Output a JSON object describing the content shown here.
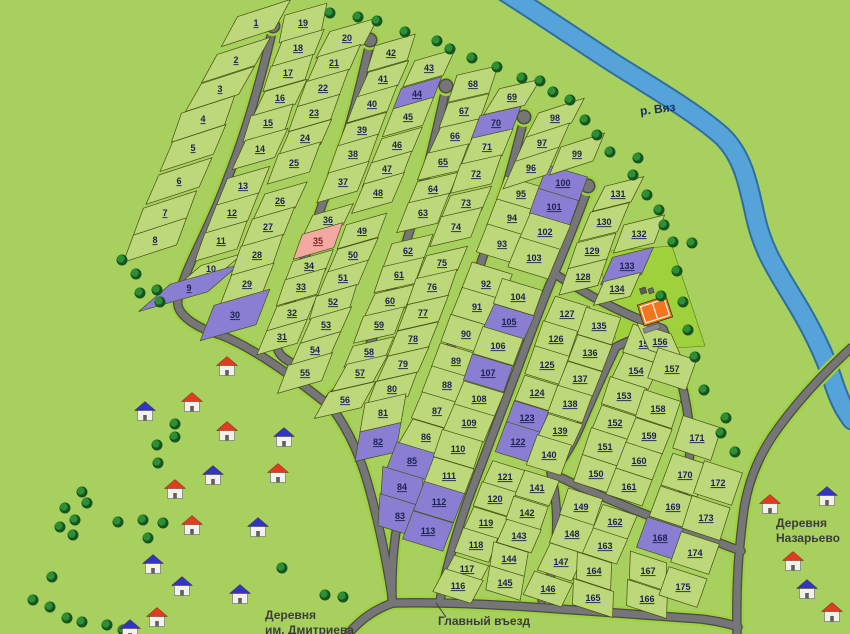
{
  "map": {
    "width": 850,
    "height": 634,
    "colors": {
      "background": "#a7d05f",
      "parcel": "#bdd77b",
      "parcel_stroke": "#45510f",
      "parcel_sold": "#8a7ed2",
      "parcel_reserved": "#f4a8a2",
      "road": "#767676",
      "road_casing": "#4a4a4a",
      "verge": "#9ed13c",
      "river": "#56a3d9",
      "river_edge": "#2f6f9f",
      "tree_dark": "#15541d",
      "tree_light": "#2e8f36",
      "court": "#f2761d",
      "number_text": "#1b2150",
      "number_text_reserved": "#7c1f1f"
    },
    "labels": {
      "river": "р. Вяз",
      "entrance": "Главный въезд",
      "village_sw": "Деревня\nим. Дмитриева",
      "village_se": "Деревня\nНазарьево"
    },
    "river": {
      "d": "M505,-8 C540,14 575,38 612,62 C650,86 695,112 722,136 C742,155 748,182 755,215 C762,248 775,268 792,296 C810,325 824,352 833,381 C840,403 846,412 852,420"
    },
    "court": {
      "x": 655,
      "y": 311,
      "rot": -18,
      "w": 30,
      "h": 22,
      "apron": "598,252 672,246 705,346 618,352"
    },
    "roads": [
      {
        "d": "M273,28 C258,92 243,140 227,180 C207,235 184,268 178,300 C175,314 196,328 221,335 C258,350 300,382 332,408 C350,432 362,460 371,495 C381,533 388,568 393,603"
      },
      {
        "d": "M370,42 C355,112 340,162 323,202 C306,252 292,300 280,334 C276,345 276,352 284,358 L296,366"
      },
      {
        "d": "M446,88 C433,150 420,198 406,243 C391,293 377,333 362,360 C353,376 341,388 330,398"
      },
      {
        "d": "M524,119 C511,172 499,214 484,254 C467,303 452,343 439,378 C426,413 416,453 406,489 C396,520 391,558 392,601"
      },
      {
        "d": "M588,188 C576,222 563,253 550,284 C536,318 524,352 511,386 C497,424 482,462 468,500 C456,534 446,568 440,601"
      },
      {
        "d": "M552,272 C578,289 606,305 634,317 L663,329"
      },
      {
        "d": "M663,329 C643,336 627,341 616,347 C603,374 591,401 580,427 C571,448 560,464 551,473"
      },
      {
        "d": "M551,473 C558,504 559,539 551,574 C549,584 545,592 542,600"
      },
      {
        "d": "M551,473 C586,490 621,505 660,520"
      },
      {
        "d": "M663,329 C678,363 687,399 690,433 C691,463 686,496 672,521"
      },
      {
        "d": "M660,520 C688,531 714,541 741,551"
      },
      {
        "d": "M851,348 C826,371 801,397 779,427 C761,451 749,477 744,509 C739,547 736,580 737,633"
      },
      {
        "d": "M349,633 C361,619 375,609 393,603 C440,602 481,604 531,607 C586,611 641,615 701,619 C716,621 728,623 738,627"
      }
    ],
    "road_bulbs": [
      [
        273,
        26
      ],
      [
        370,
        40
      ],
      [
        446,
        86
      ],
      [
        524,
        117
      ],
      [
        588,
        186
      ]
    ],
    "entrance_leader": {
      "x1": 436,
      "y1": 603,
      "x2": 446,
      "y2": 617
    }
  },
  "plots": {
    "1": [
      256,
      23
    ],
    "2": [
      236,
      60
    ],
    "3": [
      220,
      89
    ],
    "4": [
      203,
      119
    ],
    "5": [
      193,
      148
    ],
    "6": [
      179,
      181
    ],
    "7": [
      165,
      213
    ],
    "8": [
      155,
      240
    ],
    "9": [
      189,
      288,
      "p"
    ],
    "10": [
      211,
      269
    ],
    "11": [
      221,
      241
    ],
    "12": [
      232,
      213
    ],
    "13": [
      243,
      186
    ],
    "14": [
      260,
      149
    ],
    "15": [
      268,
      123
    ],
    "16": [
      280,
      98
    ],
    "17": [
      288,
      73
    ],
    "18": [
      298,
      48
    ],
    "19": [
      303,
      23
    ],
    "20": [
      347,
      38
    ],
    "21": [
      334,
      63
    ],
    "22": [
      323,
      88
    ],
    "23": [
      314,
      113
    ],
    "24": [
      305,
      138
    ],
    "25": [
      294,
      163
    ],
    "26": [
      280,
      201
    ],
    "27": [
      268,
      227
    ],
    "28": [
      257,
      255
    ],
    "29": [
      247,
      284
    ],
    "30": [
      235,
      315,
      "p"
    ],
    "31": [
      282,
      337
    ],
    "32": [
      292,
      313
    ],
    "33": [
      301,
      287
    ],
    "34": [
      309,
      266
    ],
    "35": [
      318,
      241,
      "r"
    ],
    "36": [
      328,
      220
    ],
    "37": [
      343,
      182
    ],
    "38": [
      353,
      154
    ],
    "39": [
      362,
      130
    ],
    "40": [
      372,
      104
    ],
    "41": [
      383,
      79
    ],
    "42": [
      391,
      53
    ],
    "43": [
      429,
      68
    ],
    "44": [
      417,
      94,
      "p"
    ],
    "45": [
      408,
      117
    ],
    "46": [
      397,
      145
    ],
    "47": [
      387,
      169
    ],
    "48": [
      378,
      193
    ],
    "49": [
      362,
      231
    ],
    "50": [
      353,
      255
    ],
    "51": [
      343,
      278
    ],
    "52": [
      333,
      302
    ],
    "53": [
      326,
      325
    ],
    "54": [
      315,
      350
    ],
    "55": [
      305,
      373
    ],
    "56": [
      345,
      400
    ],
    "57": [
      360,
      373
    ],
    "58": [
      369,
      352
    ],
    "59": [
      379,
      325
    ],
    "60": [
      390,
      301
    ],
    "61": [
      399,
      275
    ],
    "62": [
      408,
      251
    ],
    "63": [
      423,
      213
    ],
    "64": [
      433,
      189
    ],
    "65": [
      443,
      162
    ],
    "66": [
      455,
      136
    ],
    "67": [
      464,
      111
    ],
    "68": [
      473,
      84
    ],
    "69": [
      512,
      97
    ],
    "70": [
      496,
      123,
      "p"
    ],
    "71": [
      487,
      147
    ],
    "72": [
      476,
      174
    ],
    "73": [
      466,
      203
    ],
    "74": [
      456,
      227
    ],
    "75": [
      442,
      263
    ],
    "76": [
      432,
      287
    ],
    "77": [
      423,
      313
    ],
    "78": [
      413,
      339
    ],
    "79": [
      403,
      364
    ],
    "80": [
      392,
      389
    ],
    "81": [
      383,
      413
    ],
    "82": [
      378,
      442,
      "p"
    ],
    "83": [
      400,
      516,
      "p"
    ],
    "84": [
      402,
      487,
      "p"
    ],
    "85": [
      412,
      461,
      "p"
    ],
    "86": [
      426,
      437
    ],
    "87": [
      437,
      411
    ],
    "88": [
      447,
      385
    ],
    "89": [
      456,
      361
    ],
    "90": [
      466,
      334
    ],
    "91": [
      477,
      307
    ],
    "92": [
      486,
      284
    ],
    "93": [
      502,
      244
    ],
    "94": [
      512,
      218
    ],
    "95": [
      521,
      194
    ],
    "96": [
      531,
      168
    ],
    "97": [
      542,
      143
    ],
    "98": [
      555,
      118
    ],
    "99": [
      577,
      154
    ],
    "100": [
      563,
      183,
      "p"
    ],
    "101": [
      554,
      207,
      "p"
    ],
    "102": [
      545,
      232
    ],
    "103": [
      534,
      258
    ],
    "104": [
      518,
      297
    ],
    "105": [
      509,
      322,
      "p"
    ],
    "106": [
      498,
      346
    ],
    "107": [
      488,
      373,
      "p"
    ],
    "108": [
      479,
      399
    ],
    "109": [
      469,
      423
    ],
    "110": [
      458,
      449
    ],
    "111": [
      449,
      476
    ],
    "112": [
      439,
      502,
      "p"
    ],
    "113": [
      428,
      531,
      "p"
    ],
    "114": [
      413,
      558
    ],
    "115": [
      408,
      582
    ],
    "116": [
      458,
      586
    ],
    "117": [
      467,
      569
    ],
    "118": [
      476,
      545
    ],
    "119": [
      486,
      523
    ],
    "120": [
      495,
      499
    ],
    "121": [
      505,
      477
    ],
    "122": [
      518,
      442,
      "p"
    ],
    "123": [
      527,
      418,
      "p"
    ],
    "124": [
      537,
      393
    ],
    "125": [
      547,
      365
    ],
    "126": [
      556,
      339
    ],
    "127": [
      567,
      314
    ],
    "128": [
      583,
      277
    ],
    "129": [
      592,
      251
    ],
    "130": [
      604,
      222
    ],
    "131": [
      618,
      194
    ],
    "132": [
      639,
      234
    ],
    "133": [
      627,
      266,
      "p"
    ],
    "134": [
      617,
      289
    ],
    "135": [
      599,
      326
    ],
    "136": [
      590,
      353
    ],
    "137": [
      580,
      379
    ],
    "138": [
      570,
      404
    ],
    "139": [
      560,
      431
    ],
    "140": [
      549,
      455
    ],
    "141": [
      537,
      488
    ],
    "142": [
      527,
      513
    ],
    "143": [
      519,
      536
    ],
    "144": [
      509,
      559
    ],
    "145": [
      505,
      583
    ],
    "146": [
      548,
      589
    ],
    "147": [
      561,
      562
    ],
    "148": [
      572,
      534
    ],
    "149": [
      581,
      507
    ],
    "150": [
      596,
      474
    ],
    "151": [
      605,
      447
    ],
    "152": [
      615,
      423
    ],
    "153": [
      624,
      396
    ],
    "154": [
      636,
      371
    ],
    "155": [
      646,
      344
    ],
    "156": [
      660,
      342
    ],
    "157": [
      672,
      369
    ],
    "158": [
      658,
      409
    ],
    "159": [
      649,
      436
    ],
    "160": [
      639,
      461
    ],
    "161": [
      629,
      487
    ],
    "162": [
      615,
      522
    ],
    "163": [
      605,
      546
    ],
    "164": [
      594,
      571
    ],
    "165": [
      593,
      598
    ],
    "166": [
      647,
      599
    ],
    "167": [
      648,
      571
    ],
    "168": [
      660,
      538,
      "p"
    ],
    "169": [
      673,
      507
    ],
    "170": [
      685,
      475
    ],
    "171": [
      697,
      438
    ],
    "172": [
      718,
      483
    ],
    "173": [
      706,
      518
    ],
    "174": [
      695,
      553
    ],
    "175": [
      683,
      587
    ]
  },
  "blocks": [
    {
      "id": "b1",
      "edge": -18,
      "w": 56,
      "dir": [
        -16,
        30
      ],
      "cols": [
        [
          1,
          2,
          3,
          4,
          5,
          6,
          7,
          8
        ]
      ]
    },
    {
      "id": "b2",
      "edge": -16,
      "w": 44,
      "dir": [
        -10,
        26
      ],
      "cols": [
        [
          19,
          18,
          17,
          16,
          15,
          14,
          13,
          12,
          11,
          10,
          9
        ],
        [
          20,
          21,
          22,
          23,
          24,
          25,
          26,
          27,
          28,
          29,
          30
        ]
      ]
    },
    {
      "id": "b3",
      "edge": -16,
      "w": 42,
      "dir": [
        -10,
        26
      ],
      "cols": [
        [
          42,
          41,
          40,
          39,
          38,
          37,
          36,
          35,
          34,
          33,
          32,
          31
        ],
        [
          43,
          44,
          45,
          46,
          47,
          48,
          49,
          50,
          51,
          52,
          53,
          54
        ],
        [
          55
        ]
      ]
    },
    {
      "id": "b4",
      "edge": -13,
      "w": 42,
      "dir": [
        -10,
        26
      ],
      "cols": [
        [
          68,
          67,
          66,
          65,
          64,
          63,
          62,
          61,
          60,
          59,
          58,
          57,
          56
        ],
        [
          69,
          70,
          71,
          72,
          73,
          74,
          75,
          76,
          77,
          78,
          79,
          80,
          81,
          82
        ]
      ]
    },
    {
      "id": "b5",
      "edge": 17,
      "w": 42,
      "dir": [
        -10,
        26
      ],
      "cols": [
        [
          95,
          94,
          93,
          92,
          91,
          90,
          89,
          88,
          87,
          86,
          85,
          84,
          83
        ],
        [
          100,
          101,
          102,
          103,
          104,
          105,
          106,
          107,
          108,
          109,
          110,
          111,
          112,
          113
        ]
      ]
    },
    {
      "id": "b6",
      "edge": -18,
      "w": 46,
      "dir": [
        -11,
        27
      ],
      "cols": [
        [
          98,
          97,
          96
        ],
        [
          99
        ]
      ]
    },
    {
      "id": "b7",
      "edge": -14,
      "w": 40,
      "dir": [
        -11,
        27
      ],
      "cols": [
        [
          131,
          130,
          129,
          128
        ],
        [
          132,
          133,
          134
        ]
      ]
    },
    {
      "id": "b8",
      "edge": 17,
      "w": 36,
      "dir": [
        -10,
        25
      ],
      "cols": [
        [
          127,
          126,
          125,
          124,
          123,
          122,
          121,
          120,
          119,
          118,
          117,
          116
        ],
        [
          135,
          136,
          137,
          138,
          139,
          140,
          141,
          142,
          143,
          144,
          145
        ]
      ]
    },
    {
      "id": "b9",
      "edge": 18,
      "w": 36,
      "dir": [
        -10,
        25
      ],
      "cols": [
        [
          149,
          148,
          147,
          146
        ],
        [
          162,
          163,
          164,
          165
        ]
      ]
    },
    {
      "id": "b10",
      "edge": 18,
      "w": 38,
      "dir": [
        -10,
        26
      ],
      "cols": [
        [
          155,
          154,
          153,
          152,
          151,
          150
        ],
        [
          156,
          157,
          158,
          159,
          160,
          161
        ]
      ]
    },
    {
      "id": "b11",
      "edge": 18,
      "w": 38,
      "dir": [
        -2,
        28
      ],
      "cols": [
        [
          168,
          167,
          166
        ]
      ]
    },
    {
      "id": "b12",
      "edge": 18,
      "w": 38,
      "dir": [
        -12,
        34
      ],
      "cols": [
        [
          171,
          170,
          169
        ],
        [
          172,
          173,
          174,
          175
        ]
      ]
    }
  ],
  "plot_size_overrides": {
    "9": [
      72,
      42
    ],
    "30": [
      58,
      38
    ],
    "55": [
      46,
      30
    ],
    "56": [
      48,
      30
    ],
    "96": [
      46,
      30
    ],
    "97": [
      46,
      28
    ],
    "98": [
      48,
      28
    ],
    "99": [
      46,
      30
    ],
    "92": [
      42,
      34
    ],
    "93": [
      42,
      30
    ],
    "128": [
      40,
      28
    ],
    "131": [
      40,
      28
    ],
    "132": [
      42,
      30
    ],
    "133": [
      42,
      30
    ],
    "134": [
      38,
      26
    ],
    "155": [
      38,
      30
    ],
    "156": [
      36,
      30
    ],
    "157": [
      40,
      32
    ],
    "169": [
      38,
      32
    ],
    "170": [
      38,
      34
    ],
    "171": [
      40,
      34
    ],
    "172": [
      40,
      34
    ],
    "173": [
      40,
      34
    ],
    "174": [
      40,
      32
    ],
    "175": [
      40,
      30
    ],
    "82": [
      42,
      30
    ],
    "83": [
      44,
      32
    ],
    "113": [
      42,
      30
    ],
    "116": [
      40,
      26
    ],
    "146": [
      40,
      26
    ],
    "165": [
      42,
      26
    ],
    "166": [
      42,
      26
    ],
    "1": [
      56,
      34
    ],
    "19": [
      44,
      28
    ],
    "20": [
      50,
      30
    ]
  },
  "trees": [
    [
      330,
      13
    ],
    [
      358,
      17
    ],
    [
      377,
      21
    ],
    [
      405,
      32
    ],
    [
      437,
      41
    ],
    [
      450,
      49
    ],
    [
      472,
      58
    ],
    [
      497,
      67
    ],
    [
      522,
      78
    ],
    [
      540,
      81
    ],
    [
      553,
      92
    ],
    [
      570,
      100
    ],
    [
      585,
      120
    ],
    [
      597,
      135
    ],
    [
      610,
      152
    ],
    [
      638,
      158
    ],
    [
      633,
      175
    ],
    [
      647,
      195
    ],
    [
      659,
      210
    ],
    [
      664,
      225
    ],
    [
      673,
      242
    ],
    [
      692,
      243
    ],
    [
      677,
      271
    ],
    [
      683,
      302
    ],
    [
      688,
      330
    ],
    [
      695,
      357
    ],
    [
      704,
      390
    ],
    [
      726,
      418
    ],
    [
      721,
      433
    ],
    [
      735,
      452
    ],
    [
      122,
      260
    ],
    [
      136,
      274
    ],
    [
      157,
      290
    ],
    [
      140,
      293
    ],
    [
      160,
      302
    ],
    [
      175,
      424
    ],
    [
      175,
      437
    ],
    [
      157,
      445
    ],
    [
      158,
      463
    ],
    [
      82,
      492
    ],
    [
      87,
      503
    ],
    [
      65,
      508
    ],
    [
      75,
      520
    ],
    [
      60,
      527
    ],
    [
      73,
      535
    ],
    [
      118,
      522
    ],
    [
      143,
      520
    ],
    [
      163,
      523
    ],
    [
      148,
      538
    ],
    [
      52,
      577
    ],
    [
      33,
      600
    ],
    [
      50,
      607
    ],
    [
      67,
      618
    ],
    [
      82,
      622
    ],
    [
      107,
      625
    ],
    [
      123,
      630
    ],
    [
      282,
      568
    ],
    [
      325,
      595
    ],
    [
      343,
      597
    ],
    [
      661,
      296
    ]
  ],
  "houses": [
    [
      227,
      367,
      "red"
    ],
    [
      192,
      403,
      "red"
    ],
    [
      145,
      412,
      "blue"
    ],
    [
      227,
      432,
      "red"
    ],
    [
      284,
      438,
      "blue"
    ],
    [
      213,
      476,
      "blue"
    ],
    [
      278,
      474,
      "red"
    ],
    [
      175,
      490,
      "red"
    ],
    [
      192,
      526,
      "red"
    ],
    [
      258,
      528,
      "blue"
    ],
    [
      153,
      565,
      "blue"
    ],
    [
      182,
      587,
      "blue"
    ],
    [
      240,
      595,
      "blue"
    ],
    [
      157,
      618,
      "red"
    ],
    [
      130,
      630,
      "blue"
    ],
    [
      770,
      505,
      "red"
    ],
    [
      827,
      497,
      "blue"
    ],
    [
      793,
      562,
      "red"
    ],
    [
      807,
      590,
      "blue"
    ],
    [
      832,
      613,
      "red"
    ]
  ]
}
